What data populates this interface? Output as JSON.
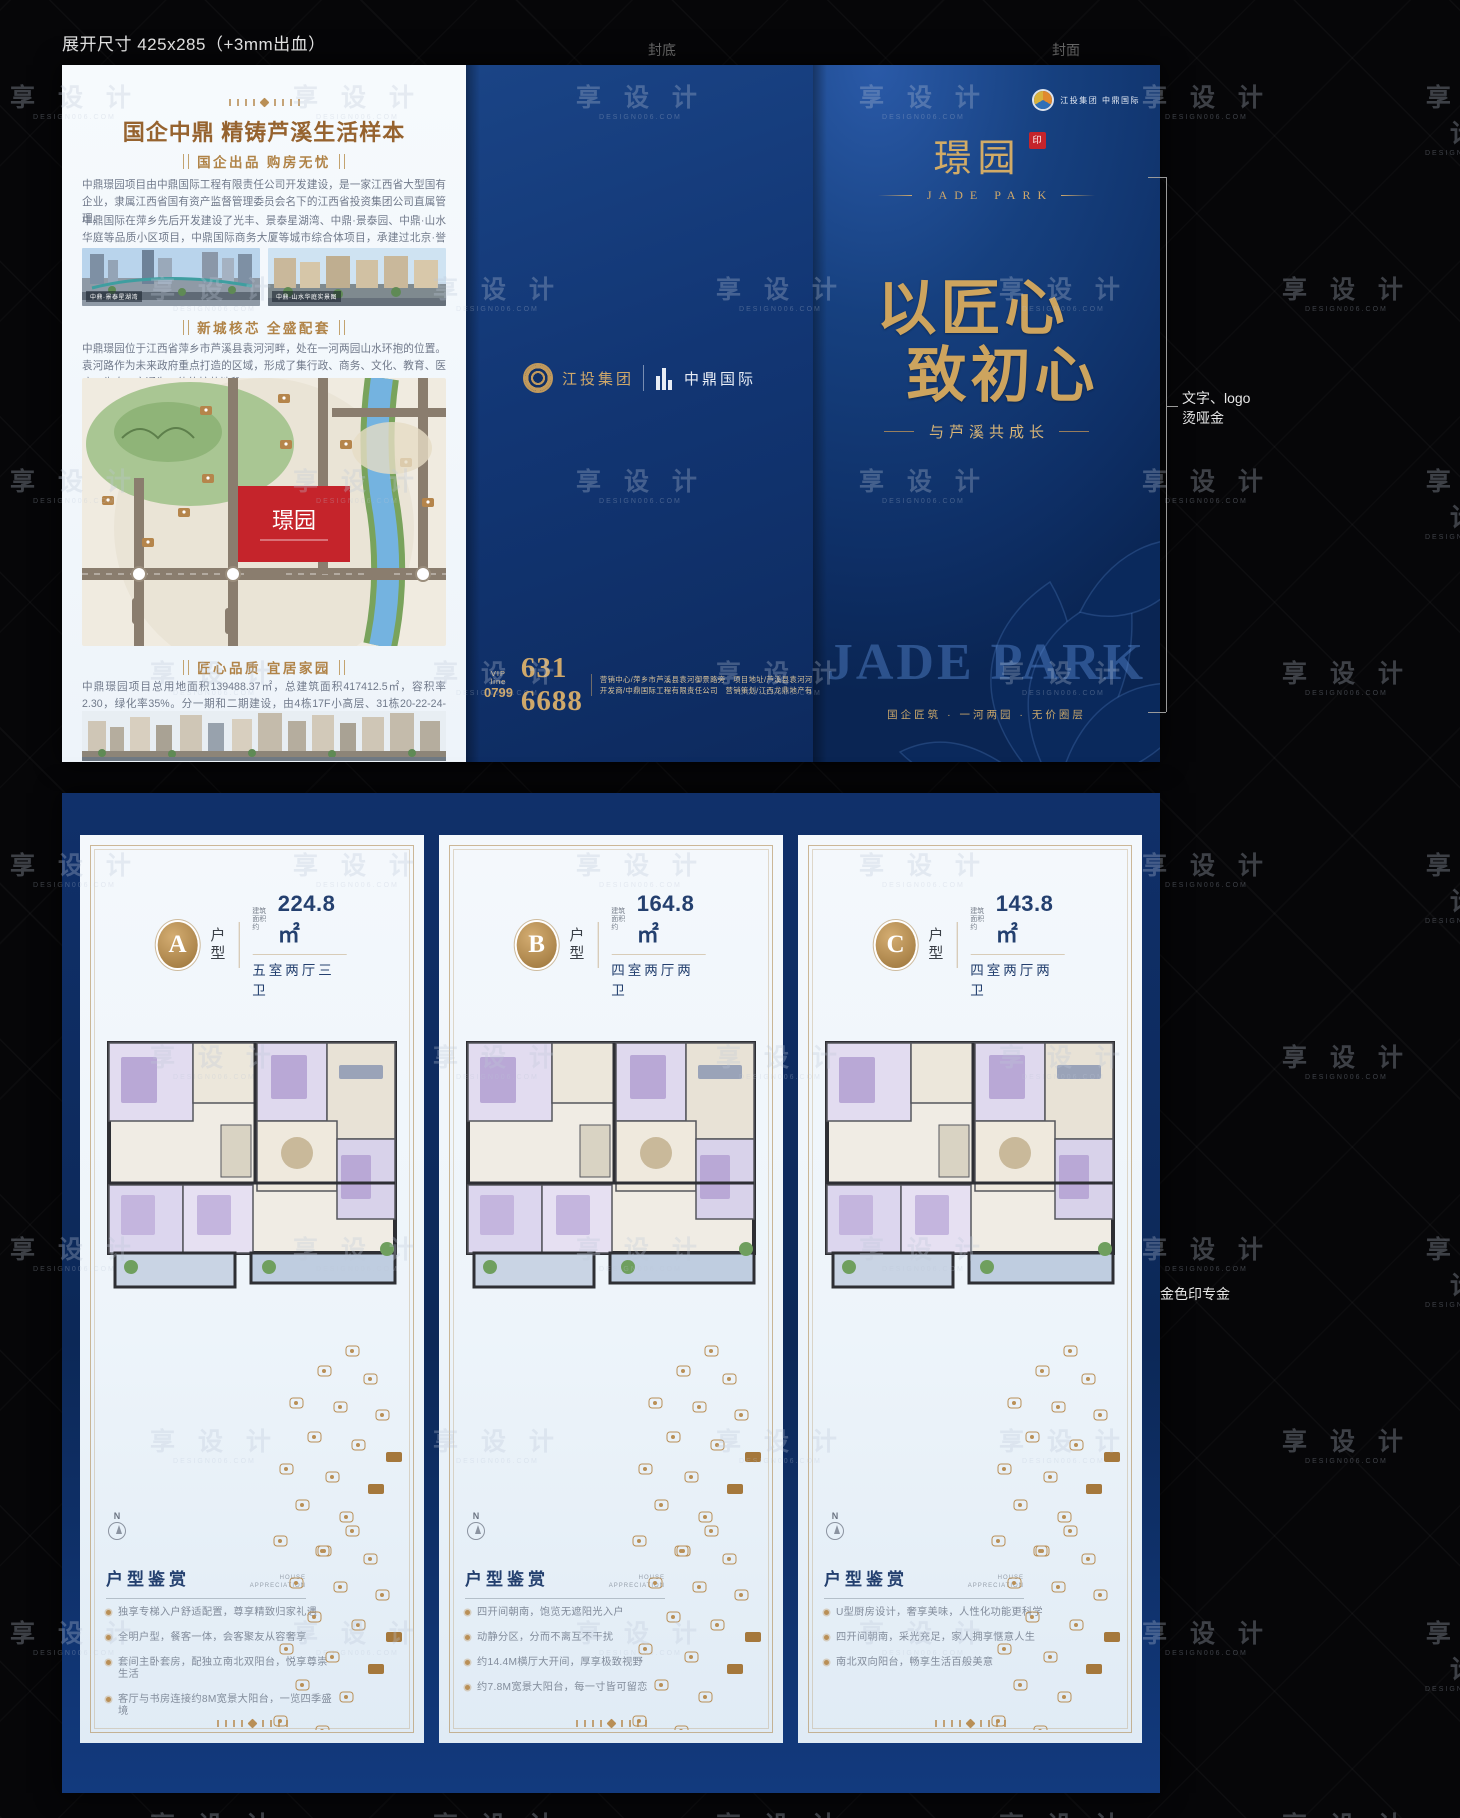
{
  "annotations": {
    "size_note": "展开尺寸 425x285（+3mm出血）",
    "fold_label_back": "封底",
    "fold_label_front": "封面",
    "foil_note_line1": "文字、logo",
    "foil_note_line2": "烫哑金",
    "gold_note": "金色印专金"
  },
  "back_panel": {
    "title": "国企中鼎 精铸芦溪生活样本",
    "section1_badge": "国企出品 购房无忧",
    "para1": "中鼎璟园项目由中鼎国际工程有限责任公司开发建设，是一家江西省大型国有企业，隶属江西省国有资产监督管理委员会名下的江西省投资集团公司直属管理。",
    "para2": "中鼎国际在萍乡先后开发建设了光丰、景泰星湖湾、中鼎·景泰园、中鼎·山水华庭等品质小区项目，中鼎国际商务大厦等城市综合体项目，承建过北京·誉城、天利园公寓楼等优质精品项目。",
    "photo1_caption": "中鼎·景泰星湖湾",
    "photo2_caption": "中鼎·山水华庭实景图",
    "section2_badge": "新城核芯 全盛配套",
    "para3": "中鼎璟园位于江西省萍乡市芦溪县袁河河畔，处在一河两园山水环抱的位置。袁河路作为未来政府重点打造的区域，形成了集行政、商务、文化、教育、医疗、生态、交通为一体的核芯地段。",
    "map_label": "璟园",
    "section3_badge": "匠心品质 宜居家园",
    "para4": "中鼎璟园项目总用地面积139488.37㎡，总建筑面积417412.5㎡，容积率2.30，绿化率35%。分一期和二期建设，由4栋17F小高层、31栋20-22-24-26F高层电梯房及部分底商组建而成。一期住宅共计1269套，车位1652个，团购房车位配比1:1.3。"
  },
  "middle_panel": {
    "logo_left": "江投集团",
    "logo_right": "中鼎国际",
    "vip_label": "VIP line",
    "vip_code": "0799",
    "phone": "631 6688",
    "info_line1": "营销中心/萍乡市芦溪县袁河御景路旁　项目地址/芦溪县袁河河畔",
    "info_line2": "开发商/中鼎国际工程有限责任公司　营销策划/江西龙鼎地产有限公司"
  },
  "cover_panel": {
    "corner_logo_text": "江投集团 中鼎国际",
    "brand_cn": "璟园",
    "seal_char": "印",
    "brand_en": "JADE PARK",
    "slogan_line1": "以匠心",
    "slogan_line2": "致初心",
    "subslogan": "与芦溪共成长",
    "watermark_en": "JADE PARK",
    "tagline": "国企匠筑 · 一河两园 · 无价圈层"
  },
  "inner": {
    "section_title": "户型鉴赏",
    "section_sub1": "HOUSE",
    "section_sub2": "APPRECIATION",
    "area_label_1": "建筑",
    "area_label_2": "面积约",
    "compass": "N",
    "panels": [
      {
        "letter": "A",
        "type_label": "户型",
        "area": "224.8㎡",
        "layout": "五室两厅三卫",
        "bullets": [
          "独享专梯入户舒适配置，尊享精致归家礼遇",
          "全明户型，餐客一体，会客聚友从容奢享",
          "套间主卧套房，配独立南北双阳台，悦享尊崇生活",
          "客厅与书房连接约8M宽景大阳台，一览四季盛境"
        ]
      },
      {
        "letter": "B",
        "type_label": "户型",
        "area": "164.8㎡",
        "layout": "四室两厅两卫",
        "bullets": [
          "四开间朝南，饱览无遮阳光入户",
          "动静分区，分而不离互不干扰",
          "约14.4M横厅大开间，厚享极致视野",
          "约7.8M宽景大阳台，每一寸皆可留恋"
        ]
      },
      {
        "letter": "C",
        "type_label": "户型",
        "area": "143.8㎡",
        "layout": "四室两厅两卫",
        "bullets": [
          "U型厨房设计，奢享美味，人性化功能更科学",
          "四开间朝南，采光充足，家人拥享惬意人生",
          "南北双向阳台，畅享生活百般美意"
        ]
      }
    ]
  },
  "watermark": {
    "text": "享 设 计",
    "sub": "DESIGN006.COM"
  },
  "colors": {
    "deep_blue": "#123674",
    "gold": "#b98f56",
    "title_brown": "#96632f",
    "navy_text": "#24406f",
    "red": "#c5242b",
    "body_gray": "#70798a"
  }
}
